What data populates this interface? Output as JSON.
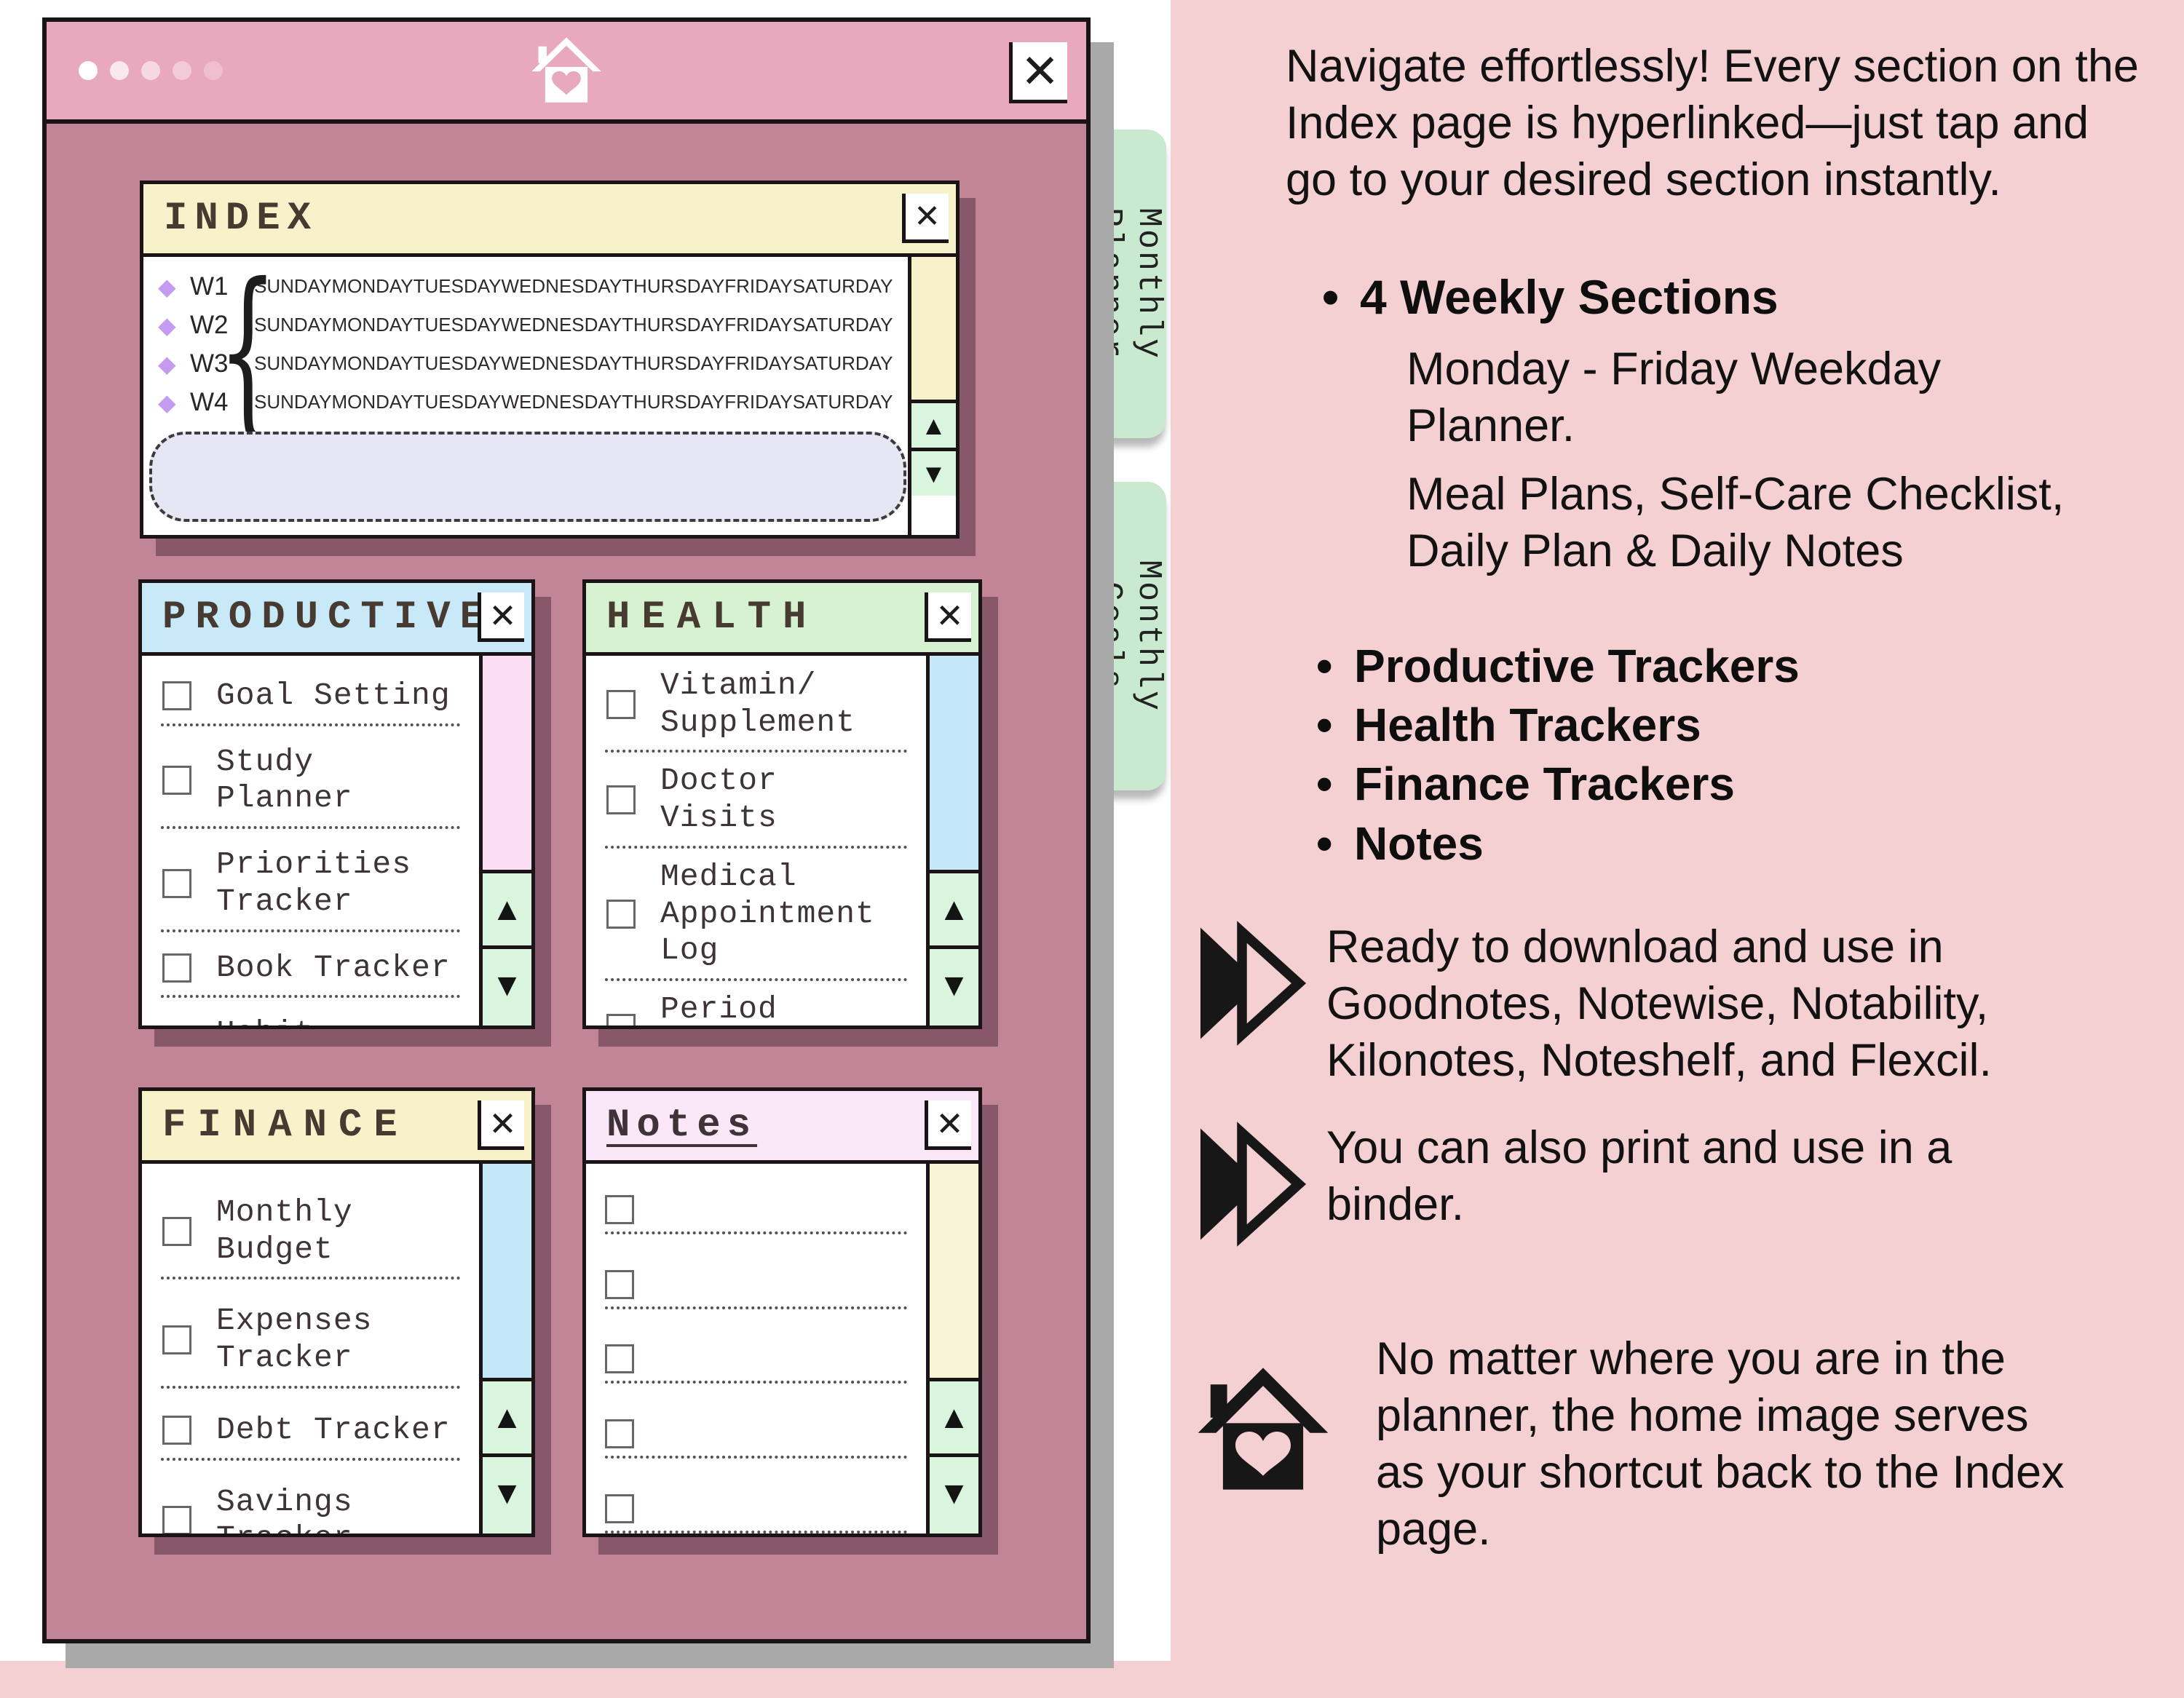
{
  "icons": {
    "close": "✕",
    "scroll_up": "▲",
    "scroll_down": "▼",
    "diamond": "◆",
    "home": "home-with-heart",
    "double_arrow": "double-chevron-right"
  },
  "colors": {
    "page_pink": "#f5d0d2",
    "window_mauve": "#c28497",
    "topbar_pink": "#e8a8bd",
    "tab_green": "#c9eace",
    "header_yellow": "#f8f2cb",
    "header_blue": "#c8e9f8",
    "header_green": "#d7f2d1",
    "header_pink": "#fae7f8",
    "button_green": "#d9f5de",
    "lavender": "#e7e6f4",
    "diamond_purple": "#c49bee"
  },
  "index": {
    "title": "INDEX",
    "weeks": [
      "W1",
      "W2",
      "W3",
      "W4"
    ],
    "days": [
      "SUNDAY",
      "MONDAY",
      "TUESDAY",
      "WEDNESDAY",
      "THURSDAY",
      "FRIDAY",
      "SATURDAY"
    ]
  },
  "panels": {
    "productive": {
      "title": "PRODUCTIVE",
      "items": [
        "Goal Setting",
        "Study Planner",
        "Priorities\nTracker",
        "Book Tracker",
        "Habit Tracker"
      ]
    },
    "health": {
      "title": "HEALTH",
      "items": [
        "Vitamin/\nSupplement",
        "Doctor Visits",
        "Medical\nAppointment Log",
        "Period Tracker",
        "Medication Tracker"
      ]
    },
    "finance": {
      "title": "FINANCE",
      "items": [
        "Monthly Budget",
        "Expenses Tracker",
        "Debt Tracker",
        "Savings Tracker",
        "Bill Payment"
      ]
    },
    "notes": {
      "title": "Notes",
      "empty_rows": 5
    }
  },
  "tabs": [
    "Monthly\nPlanner",
    "Monthly\nGoals"
  ],
  "sidebar": {
    "intro": "Navigate effortlessly! Every section on the Index page is hyperlinked—just tap and go to your desired section instantly.",
    "weekly_header": "4 Weekly Sections",
    "weekly_sub_1": "Monday - Friday Weekday Planner.",
    "weekly_sub_2": "Meal Plans, Self-Care Checklist, Daily Plan & Daily Notes",
    "tracker_bullets": [
      "Productive Trackers",
      "Health Trackers",
      "Finance Trackers",
      "Notes"
    ],
    "callout_download": "Ready to download and use in Goodnotes, Notewise, Notability, Kilonotes, Noteshelf, and Flexcil.",
    "callout_print": "You can also print and use in a binder.",
    "callout_home": "No matter where you are in the planner, the home image serves as your shortcut back to the Index page."
  }
}
